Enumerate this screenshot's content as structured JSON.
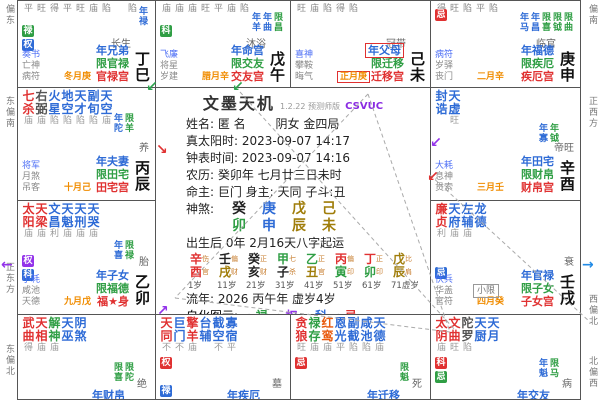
{
  "app": {
    "title": "文墨天机",
    "version": "1.2.22 预测师版",
    "edition": "CSVUC"
  },
  "center": {
    "name_label": "姓名: 匿 名",
    "gender_bureau": "阴女 金四局",
    "true_solar": "真太阳时: 2023-09-07 14:17",
    "clock_time": "钟表时间: 2023-09-07 14:16",
    "lunar": "农历: 癸卯年 七月廿三日未时",
    "masters": "命主: 巨门 身主: 天同 子斗:丑",
    "bazi_label": "神煞:",
    "bazi_stems": [
      [
        "癸",
        "#222222"
      ],
      [
        "庚",
        "#2e6bd6"
      ],
      [
        "戊",
        "#a07d0a"
      ],
      [
        "己",
        "#a07d0a"
      ]
    ],
    "bazi_branches": [
      [
        "卯",
        "#2f9e44"
      ],
      [
        "申",
        "#2e6bd6"
      ],
      [
        "辰",
        "#a07d0a"
      ],
      [
        "未",
        "#a07d0a"
      ]
    ],
    "qiyun": "出生后 0年 2月16天八字起运",
    "pillars": [
      {
        "s": "辛",
        "b": "酉",
        "sc": "#e03131",
        "bc": "#e03131",
        "ss": "伤",
        "bs": "官"
      },
      {
        "s": "壬",
        "b": "戌",
        "sc": "#222222",
        "bc": "#a07d0a",
        "ss": "偏",
        "bs": "财"
      },
      {
        "s": "癸",
        "b": "亥",
        "sc": "#222222",
        "bc": "#222222",
        "ss": "正",
        "bs": "财"
      },
      {
        "s": "甲",
        "b": "子",
        "sc": "#2f9e44",
        "bc": "#222222",
        "ss": "七",
        "bs": "杀"
      },
      {
        "s": "乙",
        "b": "丑",
        "sc": "#2f9e44",
        "bc": "#a07d0a",
        "ss": "正",
        "bs": "官"
      },
      {
        "s": "丙",
        "b": "寅",
        "sc": "#e03131",
        "bc": "#2f9e44",
        "ss": "偏",
        "bs": "印"
      },
      {
        "s": "丁",
        "b": "卯",
        "sc": "#e03131",
        "bc": "#2f9e44",
        "ss": "正",
        "bs": "印"
      },
      {
        "s": "戊",
        "b": "辰",
        "sc": "#a07d0a",
        "bc": "#a07d0a",
        "ss": "比",
        "bs": "肩"
      }
    ],
    "ages": [
      "1岁",
      "11岁",
      "21岁",
      "31岁",
      "41岁",
      "51岁",
      "61岁",
      "71虚岁"
    ],
    "liunian": "流年: 2026 丙午年 虚岁4岁",
    "zihua_label": "自化图示:",
    "zihua": [
      [
        "禄",
        "#2f9e44"
      ],
      [
        "权",
        "#9333ea"
      ],
      [
        "科",
        "#2e6bd6"
      ],
      [
        "忌",
        "#e03131"
      ]
    ]
  },
  "palaces": [
    {
      "id": "si",
      "bright_row": "平旺得平旺庙陷　陷",
      "badges": [
        [
          "禄",
          "#2f9e44"
        ],
        [
          "权",
          "#2e6bd6"
        ]
      ],
      "minis": [
        [
          "年禄",
          "#2e6bd6"
        ]
      ],
      "small": [
        "奏书",
        "亡神",
        "病符"
      ],
      "month": "冬月庚",
      "stage": "长生",
      "gz": "丁巳",
      "labels": {
        "year": "年兄弟",
        "limit": "限官禄",
        "palace": "官禄宫"
      }
    },
    {
      "id": "wu",
      "bright_row": "庙庙庙旺平庙陷",
      "badges": [
        [
          "科",
          "#2f9e44"
        ]
      ],
      "minis": [
        [
          "年羊",
          "#2e6bd6"
        ],
        [
          "年曲",
          "#2e6bd6"
        ],
        [
          "限昌",
          "#2f9e44"
        ]
      ],
      "small": [
        "飞廉",
        "将星",
        "岁建"
      ],
      "month": "腊月辛",
      "stage": "沐浴",
      "gz": "戊午",
      "labels": {
        "year": "年命宫",
        "limit": "限交友",
        "palace": "交友宫"
      }
    },
    {
      "id": "wei",
      "bright_row": "旺庙陷得陷",
      "small": [
        "喜神",
        "攀鞍",
        "晦气"
      ],
      "month": "正月庚",
      "month_boxed": true,
      "stage": "冠带",
      "gz": "己未",
      "year_boxed": true,
      "labels": {
        "year": "年父母",
        "limit": "限迁移",
        "palace": "迁移宫"
      }
    },
    {
      "id": "shen",
      "bright_row": "得旺陷平陷",
      "badges": [
        [
          "忌",
          "#e03131"
        ]
      ],
      "minis": [
        [
          "年马",
          "#2e6bd6"
        ],
        [
          "年昌",
          "#2e6bd6"
        ],
        [
          "限喜",
          "#2f9e44"
        ],
        [
          "限钺",
          "#2f9e44"
        ],
        [
          "限曲",
          "#2f9e44"
        ]
      ],
      "small": [
        "病符",
        "岁驿",
        "丧门"
      ],
      "month": "二月辛",
      "stage": "临官",
      "gz": "庚申",
      "labels": {
        "year": "年福德",
        "limit": "限疾厄",
        "palace": "疾厄宫"
      }
    },
    {
      "id": "chen",
      "stars": [
        [
          "七杀",
          "#e03131",
          "庙"
        ],
        [
          "右弼",
          "#555555",
          "庙"
        ],
        [
          "火星",
          "#2e6bd6",
          "陷"
        ],
        [
          "地空",
          "#2e6bd6",
          "陷"
        ],
        [
          "天才",
          "#2e6bd6",
          "陷"
        ],
        [
          "副旬",
          "#2e6bd6",
          "陷"
        ],
        [
          "天空",
          "#2e6bd6",
          "庙"
        ]
      ],
      "minis": [
        [
          "年陀",
          "#2e6bd6"
        ],
        [
          "限羊",
          "#2f9e44"
        ]
      ],
      "small": [
        "将军",
        "月煞",
        "吊客"
      ],
      "month": "十月己",
      "stage": "养",
      "gz": "丙辰",
      "labels": {
        "year": "年夫妻",
        "limit": "限田宅",
        "palace": "田宅宫"
      }
    },
    {
      "id": "you",
      "stars": [
        [
          "封诰",
          "#2e6bd6",
          ""
        ],
        [
          "天虚",
          "#2e6bd6",
          "旺"
        ]
      ],
      "minis": [
        [
          "年寡",
          "#2e6bd6"
        ],
        [
          "年钺",
          "#2f9e44"
        ]
      ],
      "small": [
        "大耗",
        "息神",
        "贯索"
      ],
      "month": "三月壬",
      "stage": "帝旺",
      "gz": "辛酉",
      "labels": {
        "year": "年田宅",
        "limit": "限财帛",
        "palace": "财帛宫"
      }
    },
    {
      "id": "mao",
      "stars": [
        [
          "太阳",
          "#e03131",
          "庙"
        ],
        [
          "天梁",
          "#e03131",
          "庙"
        ],
        [
          "文昌",
          "#2e6bd6",
          "利"
        ],
        [
          "天魁",
          "#2e6bd6",
          "庙"
        ],
        [
          "天刑",
          "#2e6bd6",
          "庙"
        ],
        [
          "天哭",
          "#2e6bd6",
          "庙"
        ]
      ],
      "badges": [
        [
          "权",
          "#9333ea"
        ],
        [
          "科",
          "#2e6bd6"
        ]
      ],
      "minis": [
        [
          "年喜",
          "#2e6bd6"
        ],
        [
          "限禄",
          "#2f9e44"
        ]
      ],
      "small": [
        "小耗",
        "咸池",
        "天德"
      ],
      "month": "九月戊",
      "stage": "胎",
      "gz": "乙卯",
      "labels": {
        "year": "年子女",
        "limit": "限福德",
        "palace": "福★身"
      }
    },
    {
      "id": "xu",
      "stars": [
        [
          "廉贞",
          "#e03131",
          "利"
        ],
        [
          "天府",
          "#2e6bd6",
          "庙"
        ],
        [
          "左辅",
          "#2e6bd6",
          "庙"
        ],
        [
          "龙德",
          "#2e6bd6",
          ""
        ]
      ],
      "badges": [
        [
          "忌",
          "#2e6bd6"
        ]
      ],
      "limit_box": "小限",
      "small": [
        "伏兵",
        "华盖",
        "官符"
      ],
      "month": "四月癸",
      "stage": "衰",
      "gz": "壬戌",
      "labels": {
        "year": "年官禄",
        "limit": "限子女",
        "palace": "子女宫"
      }
    },
    {
      "id": "yin",
      "stars": [
        [
          "武曲",
          "#e03131",
          "得"
        ],
        [
          "天相",
          "#e03131",
          "庙"
        ],
        [
          "解神",
          "#2f9e44",
          "庙"
        ],
        [
          "天巫",
          "#2e6bd6",
          ""
        ],
        [
          "阴煞",
          "#2e6bd6",
          ""
        ]
      ],
      "minis": [
        [
          "限喜",
          "#2f9e44"
        ],
        [
          "限陀",
          "#2f9e44"
        ]
      ],
      "stage": "绝",
      "labels": {
        "year": "年财帛"
      }
    },
    {
      "id": "chou",
      "stars": [
        [
          "天同",
          "#e03131",
          "不"
        ],
        [
          "巨门",
          "#2e6bd6",
          "不"
        ],
        [
          "擎羊",
          "#e03131",
          "庙"
        ],
        [
          "台辅",
          "#2e6bd6",
          ""
        ],
        [
          "截空",
          "#2e6bd6",
          "不"
        ],
        [
          "寡宿",
          "#2e6bd6",
          "平"
        ]
      ],
      "badges": [
        [
          "权",
          "#e03131"
        ]
      ],
      "bottom_badge": [
        "禄",
        "#2e6bd6"
      ],
      "stage": "墓",
      "labels": {
        "year": "年疾厄"
      }
    },
    {
      "id": "zi",
      "stars": [
        [
          "贪狼",
          "#e03131",
          "旺"
        ],
        [
          "禄存",
          "#2f9e44",
          "庙"
        ],
        [
          "红鸾",
          "#e8590c",
          "庙"
        ],
        [
          "恩光",
          "#2e6bd6",
          "平"
        ],
        [
          "副截",
          "#2e6bd6",
          "陷"
        ],
        [
          "咸池",
          "#2e6bd6",
          "陷"
        ],
        [
          "天德",
          "#2e6bd6",
          "庙"
        ]
      ],
      "badges": [
        [
          "忌",
          "#e03131"
        ]
      ],
      "minis": [
        [
          "限魁",
          "#2f9e44"
        ]
      ],
      "stage": "死",
      "labels": {
        "year": "年迁移"
      }
    },
    {
      "id": "hai",
      "stars": [
        [
          "太阴",
          "#e03131",
          "庙"
        ],
        [
          "文曲",
          "#e03131",
          "旺"
        ],
        [
          "陀罗",
          "#555555",
          "陷"
        ],
        [
          "天厨",
          "#2e6bd6",
          ""
        ],
        [
          "天月",
          "#2e6bd6",
          ""
        ]
      ],
      "badges": [
        [
          "科",
          "#e03131"
        ],
        [
          "忌",
          "#2f9e44"
        ]
      ],
      "minis": [
        [
          "年魁",
          "#2e6bd6"
        ],
        [
          "限马",
          "#2f9e44"
        ]
      ],
      "stage": "病",
      "labels": {
        "year": "年交友"
      }
    }
  ],
  "compass": {
    "left": [
      "偏东",
      "东偏南",
      "正东方",
      "东偏北"
    ],
    "right": [
      "偏南",
      "正西方",
      "西偏北",
      "北偏西"
    ]
  },
  "arrows": [
    {
      "g": "↙",
      "c": "#2da44e",
      "x": 146,
      "y": 80
    },
    {
      "g": "↙",
      "c": "#2da44e",
      "x": 232,
      "y": 80
    },
    {
      "g": "←",
      "c": "#9333ea",
      "x": 1,
      "y": 258
    },
    {
      "g": "→",
      "c": "#228be6",
      "x": 582,
      "y": 258
    },
    {
      "g": "↙",
      "c": "#9333ea",
      "x": 430,
      "y": 136
    },
    {
      "g": "↙",
      "c": "#e03131",
      "x": 427,
      "y": 170
    },
    {
      "g": "↘",
      "c": "#e03131",
      "x": 156,
      "y": 143
    },
    {
      "g": "↗",
      "c": "#9333ea",
      "x": 157,
      "y": 304
    }
  ]
}
